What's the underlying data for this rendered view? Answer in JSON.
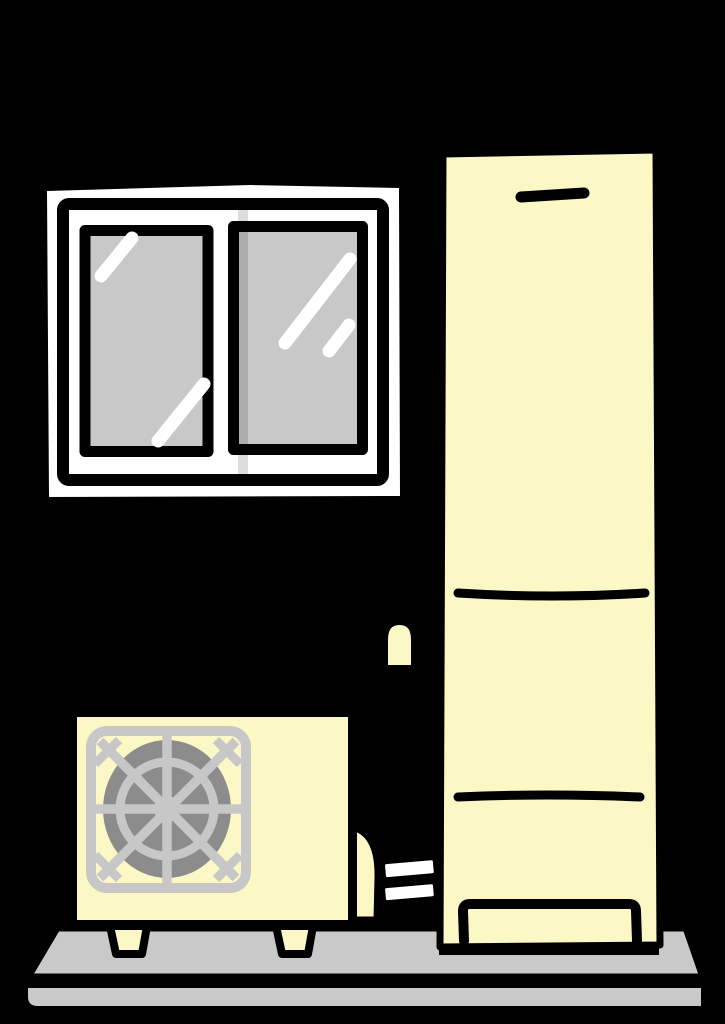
{
  "description": "Cartoon clip-art illustration of an eco-cute heat pump water heater installation: an outdoor heat pump unit and a tall cream hot-water storage tank standing on a gray concrete base, with a white sliding window above, all on a black background.",
  "objects": {
    "window": "two-pane sliding window with gray glass and white reflections",
    "storage_tank": "tall cream hot-water storage tank with seam lines and bottom service panel",
    "heat_pump": "cream outdoor heat pump unit with round gray fan grille and two feet",
    "pipes": "white insulated pipes running from the heat pump to the tank",
    "pipe_stub": "small cream pipe stub arch beside the tank",
    "base": "two-layer gray concrete base slab"
  },
  "colors": {
    "background": "#000000",
    "outline": "#000000",
    "frame_white": "#FFFFFF",
    "glass_gray": "#C8C8C8",
    "reflection_white": "#FFFFFF",
    "sash_shadow": "#00000022",
    "cream": "#FBF8C6",
    "grille_gray": "#C7C7C7",
    "fan_gray": "#8C8C8C",
    "base_gray": "#C9C9C9",
    "pipe_white": "#FFFFFF"
  }
}
